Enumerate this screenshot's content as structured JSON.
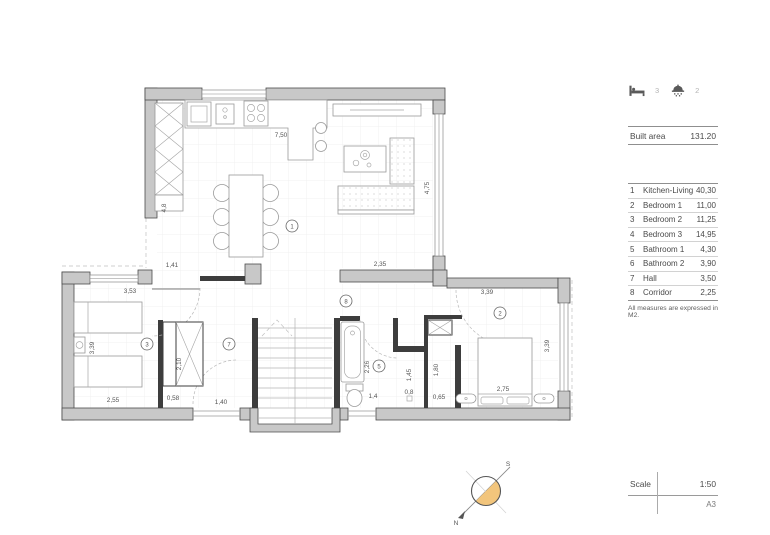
{
  "summary": {
    "bedrooms": "3",
    "bathrooms": "2"
  },
  "built_area": {
    "label": "Built area",
    "value": "131.20"
  },
  "rooms": [
    {
      "num": "1",
      "name": "Kitchen-Living",
      "area": "40,30"
    },
    {
      "num": "2",
      "name": "Bedroom 1",
      "area": "11,00"
    },
    {
      "num": "3",
      "name": "Bedroom 2",
      "area": "11,25"
    },
    {
      "num": "4",
      "name": "Bedroom 3",
      "area": "14,95"
    },
    {
      "num": "5",
      "name": "Bathroom 1",
      "area": "4,30"
    },
    {
      "num": "6",
      "name": "Bathroom 2",
      "area": "3,90"
    },
    {
      "num": "7",
      "name": "Hall",
      "area": "3,50"
    },
    {
      "num": "8",
      "name": "Corridor",
      "area": "2,25"
    }
  ],
  "note": "All measures are expressed in M2.",
  "scale": {
    "label": "Scale",
    "value": "1:50",
    "sheet": "A3"
  },
  "compass": {
    "north": "N",
    "south": "S"
  },
  "plan": {
    "dims": [
      "7,50",
      "4,8",
      "4,75",
      "1,41",
      "2,35",
      "3,53",
      "3,39",
      "2,55",
      "2,10",
      "0,58",
      "1,40",
      "3,39",
      "3,39",
      "2,26",
      "1,45",
      "1,80",
      "0,8",
      "0,65",
      "1,4",
      "2,75"
    ],
    "markers": [
      "1",
      "2",
      "3",
      "5",
      "7",
      "8"
    ]
  },
  "colors": {
    "wall": "#c8c8c8",
    "compass_fill": "#f2c57c"
  }
}
